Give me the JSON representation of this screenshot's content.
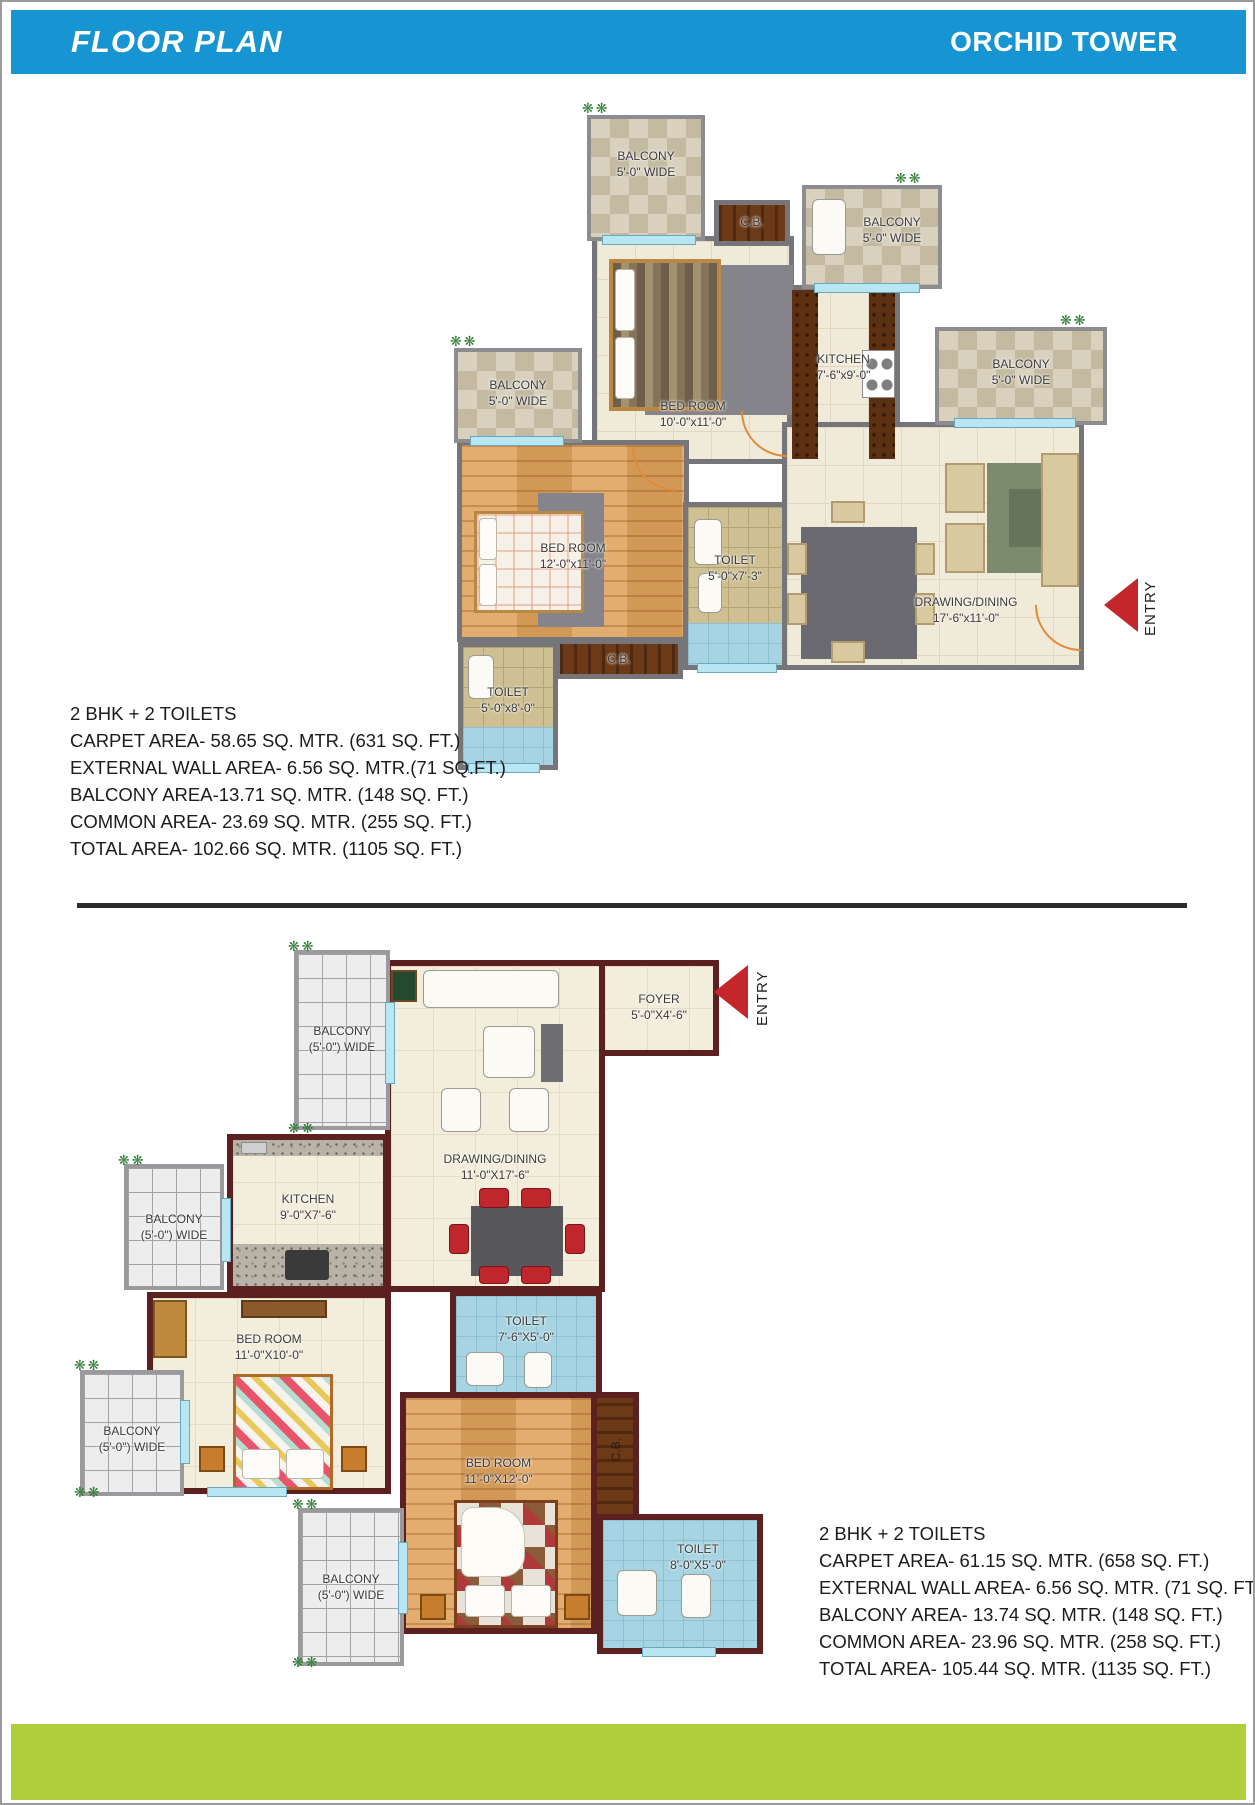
{
  "header": {
    "title": "FLOOR PLAN",
    "subtitle": "ORCHID TOWER"
  },
  "colors": {
    "header_bg": "#1695d2",
    "footer_bg": "#afce3b",
    "entry_red": "#c3262b",
    "plan1_wall": "#75757a",
    "plan2_wall": "#5c2020"
  },
  "plan1": {
    "entry": "ENTRY",
    "rooms": {
      "balcony_tl": {
        "name": "BALCONY",
        "dim": "5'-0\" WIDE"
      },
      "cb_top": {
        "name": "C.B."
      },
      "balcony_ur": {
        "name": "BALCONY",
        "dim": "5'-0\" WIDE"
      },
      "bedroom_top": {
        "name": "BED ROOM",
        "dim": "10'-0\"x11'-0\""
      },
      "kitchen": {
        "name": "KITCHEN",
        "dim": "7'-6\"x9'-0\""
      },
      "balcony_left": {
        "name": "BALCONY",
        "dim": "5'-0\" WIDE"
      },
      "balcony_right": {
        "name": "BALCONY",
        "dim": "5'-0\" WIDE"
      },
      "bedroom_left": {
        "name": "BED ROOM",
        "dim": "12'-0\"x11'-0\""
      },
      "toilet_mid": {
        "name": "TOILET",
        "dim": "5'-0\"x7'-3\""
      },
      "drawing_dining": {
        "name": "DRAWING/DINING",
        "dim": "17'-6\"x11'-0\""
      },
      "cb_bottom": {
        "name": "C.B."
      },
      "toilet_bottom": {
        "name": "TOILET",
        "dim": "5'-0\"x8'-0\""
      }
    },
    "areas": [
      "2 BHK + 2 TOILETS",
      "CARPET AREA- 58.65 SQ. MTR. (631 SQ. FT.)",
      "EXTERNAL WALL AREA- 6.56 SQ. MTR.(71 SQ.FT.)",
      "BALCONY AREA-13.71 SQ. MTR. (148 SQ. FT.)",
      "COMMON AREA- 23.69 SQ. MTR. (255 SQ. FT.)",
      "TOTAL AREA- 102.66 SQ. MTR. (1105 SQ. FT.)"
    ]
  },
  "plan2": {
    "entry": "ENTRY",
    "rooms": {
      "balcony_top": {
        "name": "BALCONY",
        "dim": "(5'-0\") WIDE"
      },
      "foyer": {
        "name": "FOYER",
        "dim": "5'-0\"X4'-6\""
      },
      "drawing_dining": {
        "name": "DRAWING/DINING",
        "dim": "11'-0\"X17'-6\""
      },
      "kitchen": {
        "name": "KITCHEN",
        "dim": "9'-0\"X7'-6\""
      },
      "balcony_left_upper": {
        "name": "BALCONY",
        "dim": "(5'-0\") WIDE"
      },
      "bedroom_1": {
        "name": "BED ROOM",
        "dim": "11'-0\"X10'-0\""
      },
      "balcony_left_lower": {
        "name": "BALCONY",
        "dim": "(5'-0\") WIDE"
      },
      "toilet_1": {
        "name": "TOILET",
        "dim": "7'-6\"X5'-0\""
      },
      "bedroom_2": {
        "name": "BED ROOM",
        "dim": "11'-0\"X12'-0\""
      },
      "cb": {
        "name": "C.B."
      },
      "toilet_2": {
        "name": "TOILET",
        "dim": "8'-0\"X5'-0\""
      },
      "balcony_bottom": {
        "name": "BALCONY",
        "dim": "(5'-0\") WIDE"
      }
    },
    "areas": [
      "2 BHK + 2 TOILETS",
      "CARPET AREA- 61.15 SQ. MTR. (658 SQ. FT.)",
      "EXTERNAL WALL AREA- 6.56 SQ. MTR. (71 SQ. FT.)",
      "BALCONY AREA- 13.74 SQ. MTR. (148 SQ. FT.)",
      "COMMON AREA- 23.96 SQ. MTR. (258 SQ. FT.)",
      "TOTAL AREA- 105.44 SQ. MTR. (1135 SQ. FT.)"
    ]
  },
  "plants_glyph": "❋❋"
}
